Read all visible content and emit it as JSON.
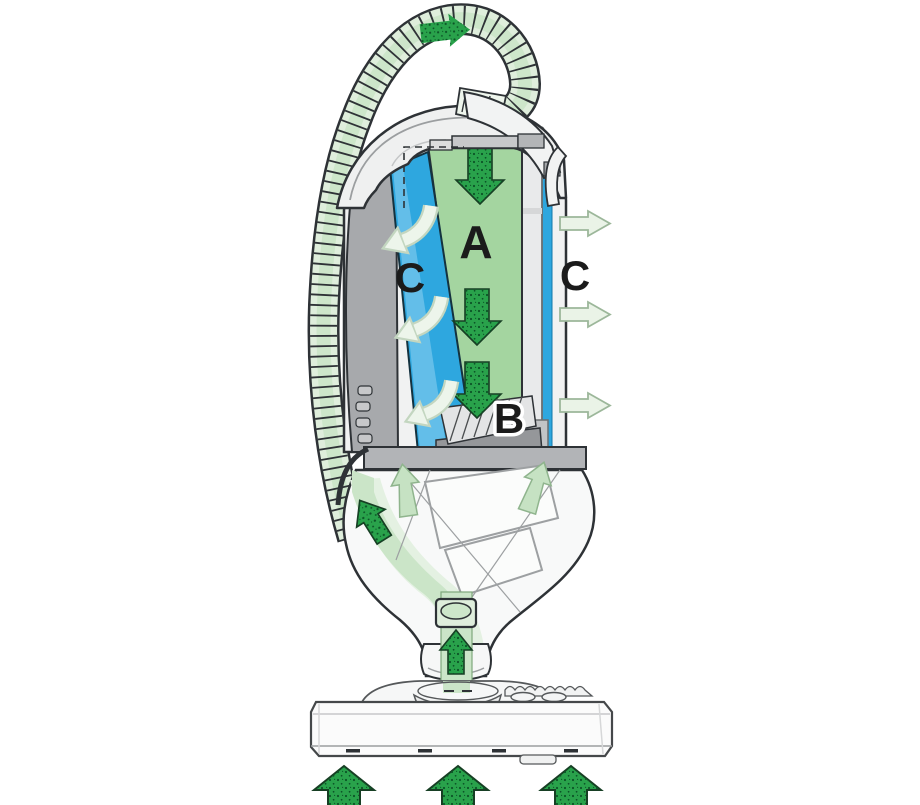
{
  "diagram": {
    "type": "upright-vacuum-airflow-cutaway",
    "labels": {
      "a": "A",
      "b": "B",
      "c_inner": "C",
      "c_outer": "C"
    },
    "colors": {
      "chamber_green": "#a4d5a0",
      "chamber_blue": "#2ea7df",
      "airflow_dark_green": "#29a24b",
      "airflow_speckle": "#0c5427",
      "airflow_pale_green": "#eaf3e7",
      "flow_band_green": "#cbe5c8",
      "hose_green": "#dfeedc",
      "body_gray": "#a7a9ac",
      "platform_gray": "#b2b4b7",
      "outline_dark": "#2e3236"
    }
  }
}
